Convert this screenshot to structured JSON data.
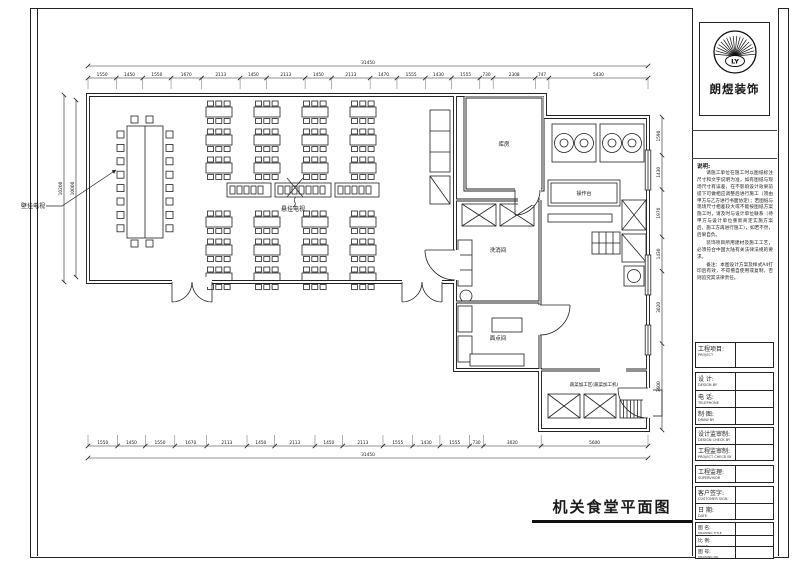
{
  "sheet": {
    "title": "机关食堂平面图",
    "company": "朗煜装饰",
    "logo_monogram": "LY",
    "colors": {
      "ink": "#1a1a1a",
      "paper": "#ffffff"
    }
  },
  "notes": {
    "heading": "说明:",
    "paragraphs": [
      "请施工单位在施工时以图纸标注尺寸和文字说明为准，如有图纸与现场尺寸有误差，在不影响设计效果前提下可做相应调整后进行施工（须由甲方与乙方进行书面协定）；若图纸与现场尺寸相差较大或不能按图纸方案施工时，请及时与设计单位联系（待甲方与设计单位重新商定实施方案后，施工方再进行施工），如若不然，后果自负。",
      "装饰项目所用建材及施工工艺，必须符合中国大陆有关法律法规的要求。",
      "备注：本图设计方案及样式A4打印后有效，不得擅自使用或复制，否则追究其法律责任。"
    ]
  },
  "titleblock": {
    "rows": [
      {
        "label": "工程项目:",
        "sub": "PROJECT",
        "value": ""
      },
      {
        "label": "设  计:",
        "sub": "DESIGN BY",
        "value": ""
      },
      {
        "label": "电  话:",
        "sub": "TELEPHONE",
        "value": ""
      },
      {
        "label": "制  图:",
        "sub": "DRAW BY",
        "value": ""
      },
      {
        "label": "设计监审制:",
        "sub": "DESIGN CHECK BY",
        "value": ""
      },
      {
        "label": "工程监审制:",
        "sub": "PROJECT CHECK BY",
        "value": ""
      },
      {
        "label": "工程监理:",
        "sub": "SUPERVISOR",
        "value": ""
      },
      {
        "label": "客户签字:",
        "sub": "CUSTOMER SIGN",
        "value": ""
      },
      {
        "label": "日  期:",
        "sub": "DATE",
        "value": ""
      },
      {
        "label": "图  名:",
        "sub": "DRAWING TITLE",
        "value": ""
      },
      {
        "label": "比  例:",
        "sub": "SCALE",
        "value": ""
      },
      {
        "label": "图  号:",
        "sub": "DRAWING NO.",
        "value": ""
      }
    ]
  },
  "plan": {
    "labels": {
      "wall_tv": "壁挂电视",
      "hanging_tv": "悬挂电视",
      "storage": "库房",
      "worktable": "操作台",
      "wash": "洗消间",
      "pastry": "面点间",
      "veg": "蔬菜加工区(蔬菜加工机)"
    },
    "dims": {
      "top": [
        "1550",
        "1450",
        "1550",
        "1670",
        "2113",
        "1450",
        "2113",
        "1450",
        "2113",
        "1470",
        "1555",
        "1430",
        "1555",
        "730",
        "2308",
        "747",
        "5430"
      ],
      "top_total": "31450",
      "bottom": [
        "1550",
        "1450",
        "1550",
        "1670",
        "2113",
        "1450",
        "2113",
        "1450",
        "2113",
        "1555",
        "1430",
        "1555",
        "730",
        "3020",
        "5600"
      ],
      "bottom_total": "31450",
      "left_outer": "10200",
      "left_inner": "10000",
      "right": [
        "1590",
        "1430",
        "1970",
        "1430",
        "3020",
        "3600"
      ]
    }
  }
}
